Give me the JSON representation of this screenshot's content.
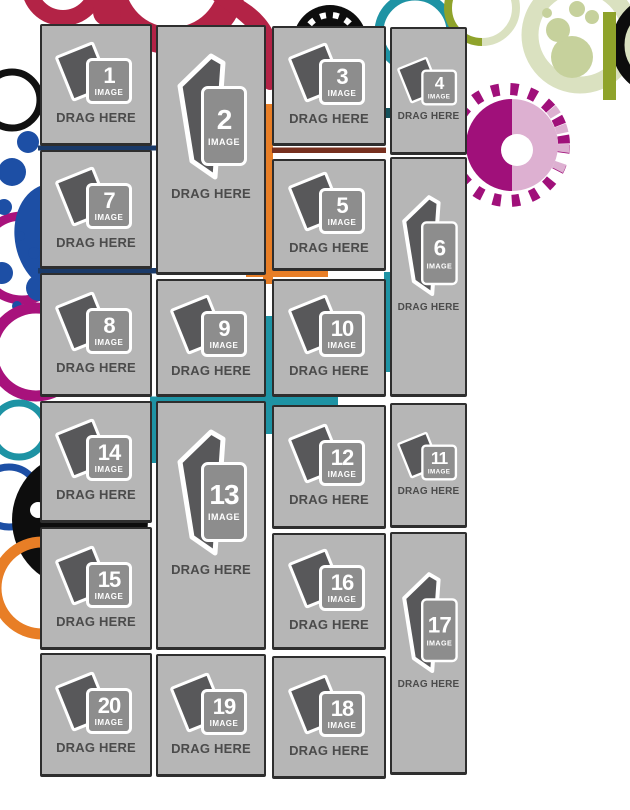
{
  "app": {
    "description": "photo collage drag-and-drop template with numbered image placeholders"
  },
  "labels": {
    "drag_here": "DRAG HERE",
    "image": "IMAGE"
  },
  "slots": [
    {
      "number": "1"
    },
    {
      "number": "2"
    },
    {
      "number": "3"
    },
    {
      "number": "4"
    },
    {
      "number": "5"
    },
    {
      "number": "6"
    },
    {
      "number": "7"
    },
    {
      "number": "8"
    },
    {
      "number": "9"
    },
    {
      "number": "10"
    },
    {
      "number": "11"
    },
    {
      "number": "12"
    },
    {
      "number": "13"
    },
    {
      "number": "14"
    },
    {
      "number": "15"
    },
    {
      "number": "16"
    },
    {
      "number": "17"
    },
    {
      "number": "18"
    },
    {
      "number": "19"
    },
    {
      "number": "20"
    }
  ],
  "colors": {
    "crimson": "#b32346",
    "royal_blue": "#1d4fa5",
    "magenta": "#a8127c",
    "magenta_deep": "#a0107a",
    "pink": "#ddb0d1",
    "teal": "#1e93a4",
    "orange": "#e87e26",
    "olive": "#8fa32b",
    "sage": "#c6d19c",
    "pale_sage": "#dae1c0",
    "navy": "#1a3a69",
    "maroon": "#77301f",
    "dark_teal": "#14525c",
    "black": "#0d0d0d",
    "slot_background": "#b6b6b6",
    "icon_box_gray": "#8d8d8d",
    "page_gray": "#58585a",
    "drag_text_gray": "#4b4b4b"
  }
}
